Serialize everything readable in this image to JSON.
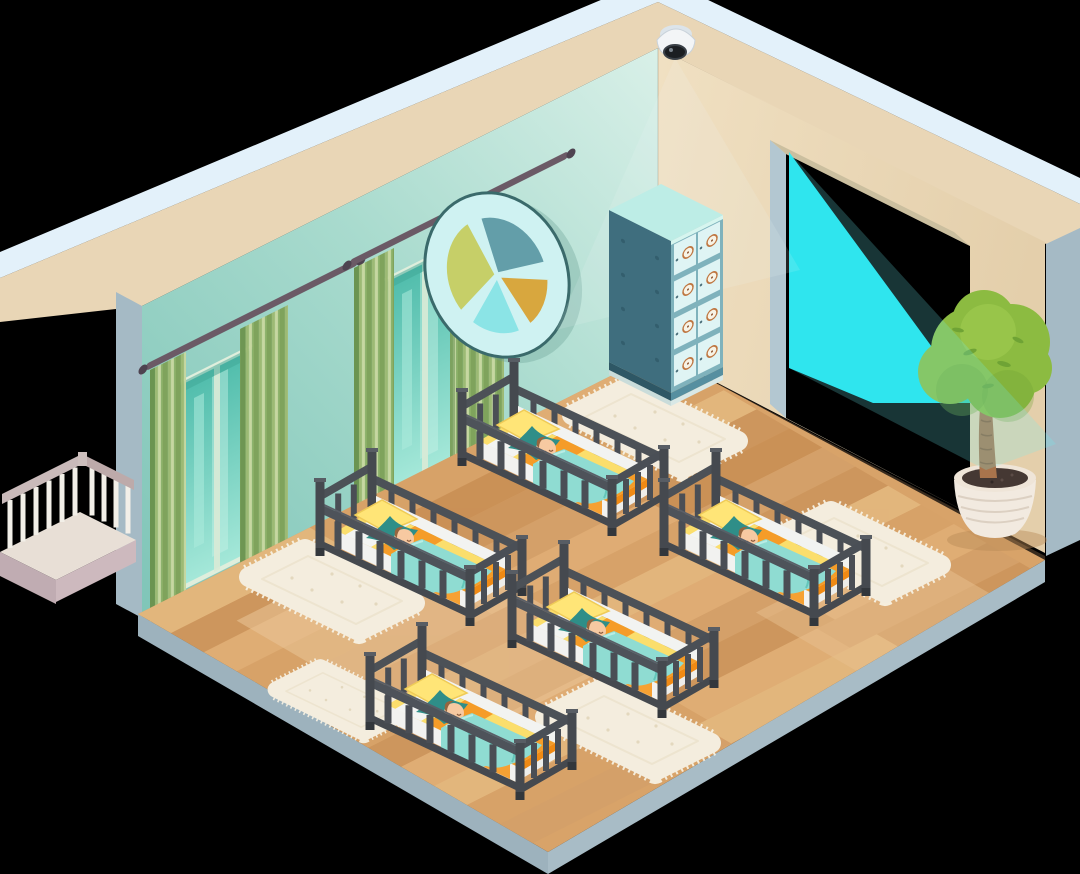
{
  "scene": {
    "style": "isometric cutaway illustration",
    "room": "nursery sleeping room",
    "objects": [
      {
        "name": "security-camera",
        "count": 1
      },
      {
        "name": "camera-light-beam",
        "count": 1
      },
      {
        "name": "pie-chart-wall-decor",
        "count": 1
      },
      {
        "name": "window-with-green-curtains",
        "count": 2
      },
      {
        "name": "locker-cabinet",
        "count": 1,
        "compartments": 8
      },
      {
        "name": "crib-with-sleeping-baby",
        "count": 5
      },
      {
        "name": "fluffy-rug",
        "count": 5
      },
      {
        "name": "potted-topiary-tree",
        "count": 1
      },
      {
        "name": "balcony-railing",
        "count": 1
      },
      {
        "name": "doorway-opening",
        "count": 1
      },
      {
        "name": "wood-plank-floor",
        "count": 1
      }
    ]
  },
  "palette": {
    "bg": "#000000",
    "wallTrim": "#E3F1FA",
    "wallBand": "#E9D6B6",
    "wallEnd": "#A5BAC5",
    "wallLeftTop": "#D9F0E8",
    "wallLeftBottom": "#7FC5B8",
    "wallRightLight": "#F0E0C2",
    "wallRightDark": "#E4CFAB",
    "floorBase": "#D8A369",
    "floorEdgeLeft": "#9DB2BD",
    "floorEdgeRight": "#A8BCC6",
    "beamBright": "#1FE9F4",
    "beamSoft": "#6FF2F7",
    "cribFrame": "#45494F",
    "cribFrameLight": "#585D64",
    "mattressWhite": "#F2F2F0",
    "sheetYellow": "#FBDE6C",
    "sheetOrange": "#F59C28",
    "blanketTeal": "#8FDCD2",
    "blanketFold": "#63C6BA",
    "pillowTeal": "#2F8E88",
    "pillowYellow": "#FFE577",
    "babySkin": "#F7C9A1",
    "babyHair": "#95653F",
    "curtainDark": "#7FA35C",
    "curtainMid": "#9DBA74",
    "curtainLight": "#C7D7A0",
    "rodColor": "#6B5A66",
    "windowGlass": "#4FBCAB",
    "windowGlassLight": "#A5E8D9",
    "lockerSide": "#3F6E7E",
    "lockerFront": "#7FB2BC",
    "lockerCell": "#DFF4F4",
    "lockerTop": "#BDEDE6",
    "dialRing": "#BF7742",
    "rugBase": "#F4EDDE",
    "rugFringe": "#F7F1E3",
    "decorFrame": "#CFF2F2",
    "decorBlue": "#639EA9",
    "decorGold": "#D8A73E",
    "decorCyan": "#8BE4E6",
    "decorGreen": "#C6CF68",
    "foliage": "#8CBB41",
    "foliageDark": "#6FA335",
    "foliageLight": "#9DC94F",
    "trunk": "#A9744C",
    "potWhite": "#F2EAE0",
    "soil": "#453833",
    "railBaluster": "#F2EFE8",
    "railTop": "#C9BABA",
    "ledgeTop": "#E8DFD6",
    "ledgeSide": "#C0ACB2",
    "cameraBody": "#F3F5F7",
    "cameraLens": "#1B1E22"
  }
}
